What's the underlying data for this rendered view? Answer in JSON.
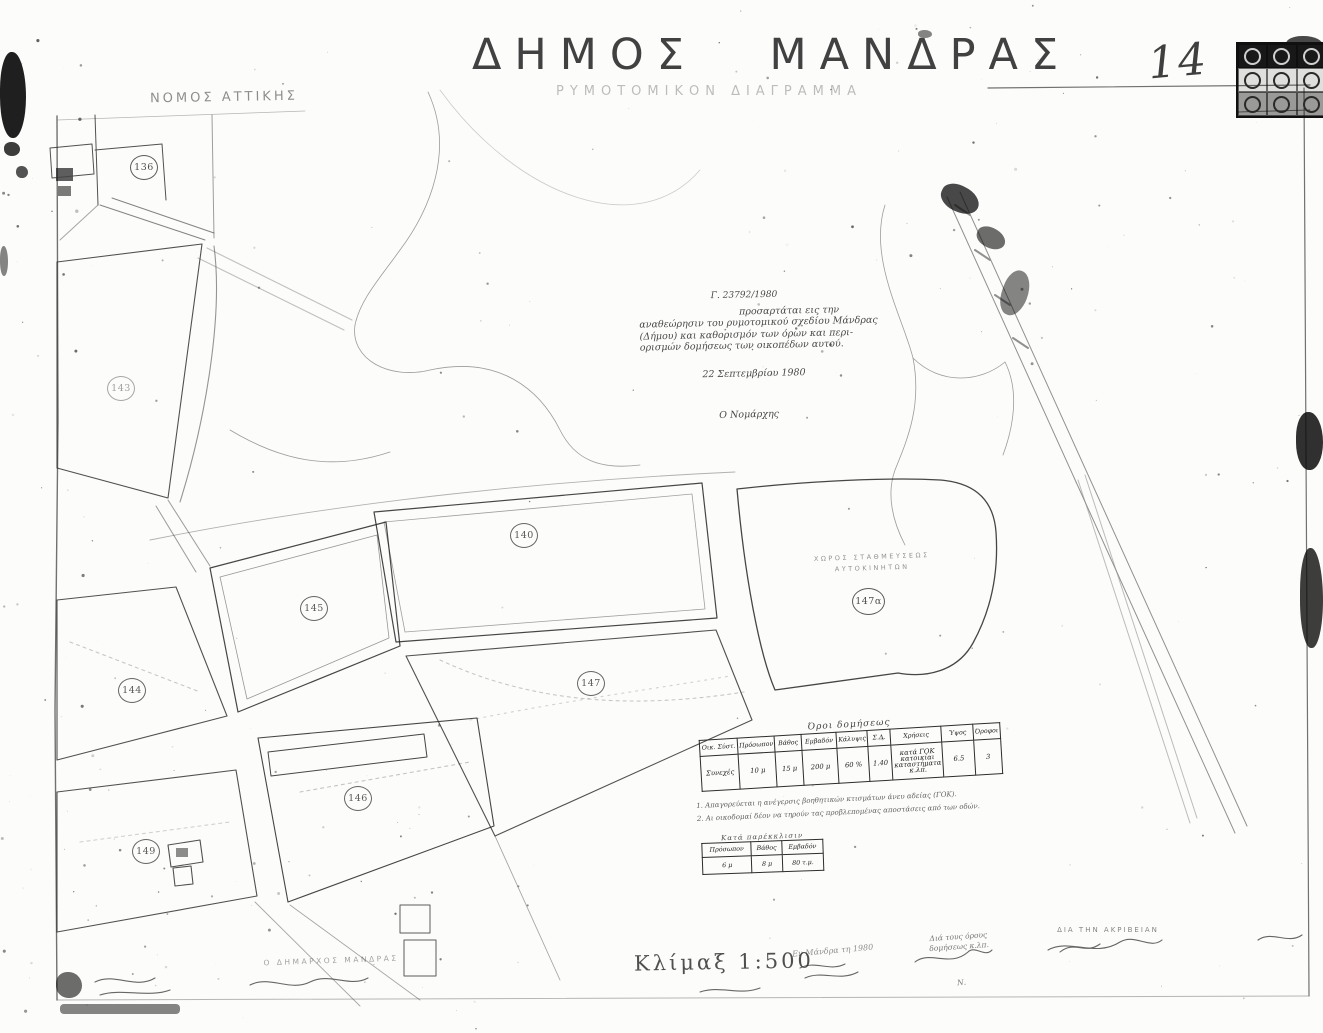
{
  "page": {
    "title": "ΔΗΜΟΣ  ΜΑΝΔΡΑΣ",
    "subtitle": "ΡΥΜΟΤΟΜΙΚΟΝ ΔΙΑΓΡΑΜΜΑ",
    "region_label": "ΝΟΜΟΣ ΑΤΤΙΚΗΣ",
    "sheet_number": "14",
    "scale_label": "Κλίμαξ 1:500",
    "ink_color": "#1e1e1e",
    "paper_color": "#fcfcfa"
  },
  "approval_note": {
    "ref": "Γ. 23792/1980",
    "line1": "προσαρτάται εις την",
    "line2": "αναθεώρησιν του ρυμοτομικού σχεδίου Μάνδρας",
    "line3": "(Δήμου) και καθορισμόν των όρων και περι-",
    "line4": "ορισμών δομήσεως των οικοπέδων αυτού.",
    "date": "22 Σεπτεμβρίου 1980",
    "signer": "Ο Νομάρχης"
  },
  "parcels": {
    "p136": "136",
    "p143": "143",
    "p140": "140",
    "p145": "145",
    "p144": "144",
    "p147": "147",
    "p147a": "147α",
    "p146": "146",
    "p149": "149"
  },
  "parking_area": {
    "line1": "ΧΩΡΟΣ ΣΤΑΘΜΕΥΣΕΩΣ",
    "line2": "ΑΥΤΟΚΙΝΗΤΩΝ"
  },
  "terms_table": {
    "title": "Όροι δομήσεως",
    "h0": "Οικ. Σύστ.",
    "h1": "Πρόσωπον",
    "h2": "Βάθος",
    "h3": "Εμβαδόν",
    "h4": "Κάλυψις",
    "h5": "Σ.Δ.",
    "h6": "Χρήσεις",
    "h7": "Ύψος",
    "h8": "Όροφοι",
    "v0": "Συνεχές",
    "v1": "10 μ",
    "v2": "15 μ",
    "v3": "200 μ",
    "v4": "60 %",
    "v5": "1.40",
    "v6": "κατά ΓΟΚ κατοικίαι καταστήματα κ.λπ.",
    "v7": "6.5",
    "v8": "3"
  },
  "notes": {
    "n1": "1. Απαγορεύεται η ανέγερσις βοηθητικών κτισμάτων άνευ αδείας (ΓΟΚ).",
    "n2": "2. Αι οικοδομαί δέον να τηρούν τας προβλεπομένας αποστάσεις από των οδών."
  },
  "derogation_table": {
    "title": "Κατά παρέκκλισιν",
    "h0": "Πρόσωπον",
    "h1": "Βάθος",
    "h2": "Εμβαδόν",
    "v0": "6 μ",
    "v1": "8 μ",
    "v2": "80 τ.μ."
  },
  "signatures": {
    "mayor": "Ο ΔΗΜΑΡΧΟΣ ΜΑΝΔΡΑΣ",
    "place_date": "Εν Μάνδρα τη 1980",
    "engineer_l1": "Διά τους όρους",
    "engineer_l2": "δομήσεως κ.λπ.",
    "engineer_name": "Ν.",
    "accuracy": "ΔΙΑ ΤΗΝ ΑΚΡΙΒΕΙΑΝ"
  }
}
